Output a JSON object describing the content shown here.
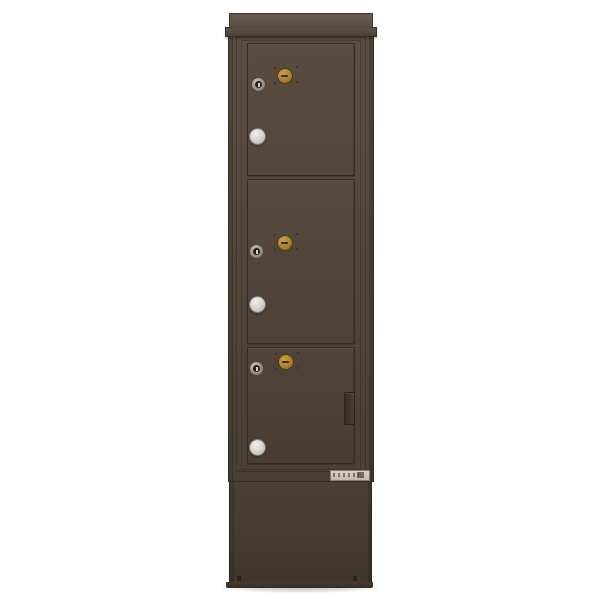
{
  "scene": {
    "description": "Front product view of a tall free-standing parcel locker mailbox cabinet with three stacked locker doors, crown cap top and pedestal base, dark bronze finish on a white background",
    "background_color": "#ffffff"
  },
  "cabinet": {
    "finish_colors": {
      "crown_cap": "#6b5c4f",
      "body_top": "#5c4e43",
      "body_bottom": "#4a3f35",
      "door_face": "#53463b",
      "trim_outline": "#362d25",
      "pedestal": "#473c32",
      "foot": "#352c24"
    },
    "door_count": 3,
    "doors": [
      {
        "position": "top",
        "hardware": [
          "arrow-lock",
          "tenant-keyhole-lock",
          "pull-knob"
        ]
      },
      {
        "position": "middle",
        "hardware": [
          "arrow-lock",
          "tenant-keyhole-lock",
          "pull-knob"
        ]
      },
      {
        "position": "bottom",
        "hardware": [
          "arrow-lock",
          "tenant-keyhole-lock",
          "pull-knob",
          "edge-pull-handle"
        ]
      }
    ],
    "hardware_colors": {
      "arrow_lock_brass": "#a8822f",
      "tenant_lock_silver": "#938d85",
      "pull_knob": "#d9d7d3",
      "handle": "#3a3129"
    },
    "compliance_label": {
      "present": true,
      "legible": false,
      "color": "#cdc6bd"
    }
  }
}
